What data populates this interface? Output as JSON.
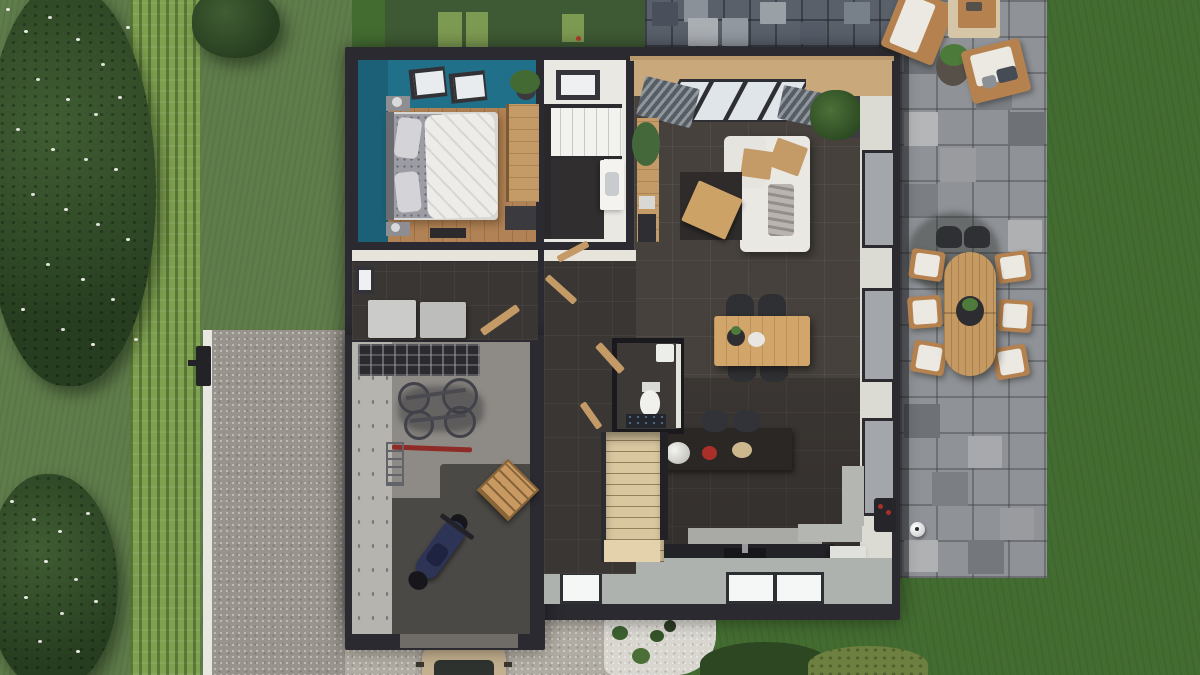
{
  "scene": {
    "title": "3D top-down render of a single-family house ground floor with garden, gravel driveway and stone terrace",
    "view": "top-down 3D floor plan render",
    "visible_text": "none"
  },
  "palette": {
    "lawn": "#436c31",
    "lawn_left": "#5f7c4b",
    "lawn_shadow": "#3e5a34",
    "hedge": "#7fa04f",
    "tree_foliage": "#2b4323",
    "flowers": "#e9ece4",
    "driveway_gravel": "#98938c",
    "apron_gravel": "#b1aca3",
    "rockery_gravel": "#d8d6cf",
    "terrace_stone": "#8f9297",
    "rear_paving": "#59606a",
    "wall": "#2b2a30",
    "interior_tile": "#46413d",
    "bedroom_wood": "#b18255",
    "accent_teal_wall": "#20708a",
    "bathroom_white": "#e9e8e3",
    "eave_tan": "#c9a87c",
    "furniture_wood": "#c49a66",
    "stairs_wood": "#d9c7a0",
    "sofa_white": "#eae8e3",
    "motorcycle_navy": "#2d3455",
    "car_beige": "#c3b08f",
    "stool_red": "#a83028"
  },
  "regions": {
    "garden_left": {
      "label": "Left garden with flowering trees and tall hedge"
    },
    "hedge": {
      "label": "Clipped hedge strip"
    },
    "driveway": {
      "label": "Gravel driveway with white kerb"
    },
    "mailbox": {
      "label": "Mailbox post at driveway"
    },
    "car": {
      "label": "Beige car at driveway entrance"
    },
    "rear_paving": {
      "label": "Rear paved path behind house"
    },
    "terrace": {
      "label": "Stone-paved side terrace"
    },
    "lawn_right": {
      "label": "Back lawn"
    },
    "rockery": {
      "label": "White-gravel planting bed with shrubs"
    },
    "bushes": {
      "label": "Round garden bushes"
    },
    "house": {
      "label": "House ground floor (open roof view)"
    }
  },
  "house": {
    "rooms": [
      {
        "id": "bedroom",
        "label": "Bedroom with teal accent wall",
        "floor": "wood",
        "furniture": [
          "double bed with white duvet",
          "two roof windows",
          "wardrobe",
          "nightstands",
          "potted plant",
          "desk"
        ]
      },
      {
        "id": "bathroom",
        "label": "Bathroom",
        "furniture": [
          "walk-in shower",
          "vanity sink",
          "window"
        ]
      },
      {
        "id": "living_room",
        "label": "Living room",
        "furniture": [
          "white corner sofa",
          "wooden trays",
          "coffee table on dark rug",
          "sideboard with plants",
          "corner plant",
          "bay window with blinds"
        ]
      },
      {
        "id": "dining_area",
        "label": "Dining area",
        "furniture": [
          "wooden dining table",
          "four dark chairs",
          "centerpiece bowl"
        ]
      },
      {
        "id": "kitchen",
        "label": "Kitchen",
        "furniture": [
          "dark island with two stools",
          "white flower bouquet",
          "red bowl",
          "rear counter with sink",
          "light bench",
          "white fridge cabinet",
          "three bottom windows"
        ]
      },
      {
        "id": "wc",
        "label": "Guest WC",
        "furniture": [
          "toilet",
          "hand basin",
          "patterned rug",
          "open wooden door"
        ]
      },
      {
        "id": "hallway",
        "label": "Hallway with open wooden doors"
      },
      {
        "id": "staircase",
        "label": "Light wooden staircase"
      },
      {
        "id": "utility_room",
        "label": "Utility room",
        "furniture": [
          "washer",
          "dryer",
          "small window",
          "open door"
        ]
      },
      {
        "id": "garage",
        "label": "Garage",
        "furniture": [
          "wall storage rack",
          "two wall-mounted bicycles",
          "red bicycle",
          "ladder",
          "navy motorcycle",
          "wooden pallet"
        ]
      }
    ]
  },
  "outdoor": {
    "dining_set": {
      "label": "Outdoor oval wooden dining table with six chairs",
      "chairs": 6,
      "table": "oval wood, center planter"
    },
    "lounge_set": {
      "label": "Two wooden lounge chairs, fire-pit table and planter"
    },
    "bbq": {
      "label": "Barbecue grill at house wall"
    },
    "ball": {
      "label": "Soccer ball on terrace"
    },
    "grass_pavers": {
      "label": "Light grass squares behind house"
    }
  }
}
